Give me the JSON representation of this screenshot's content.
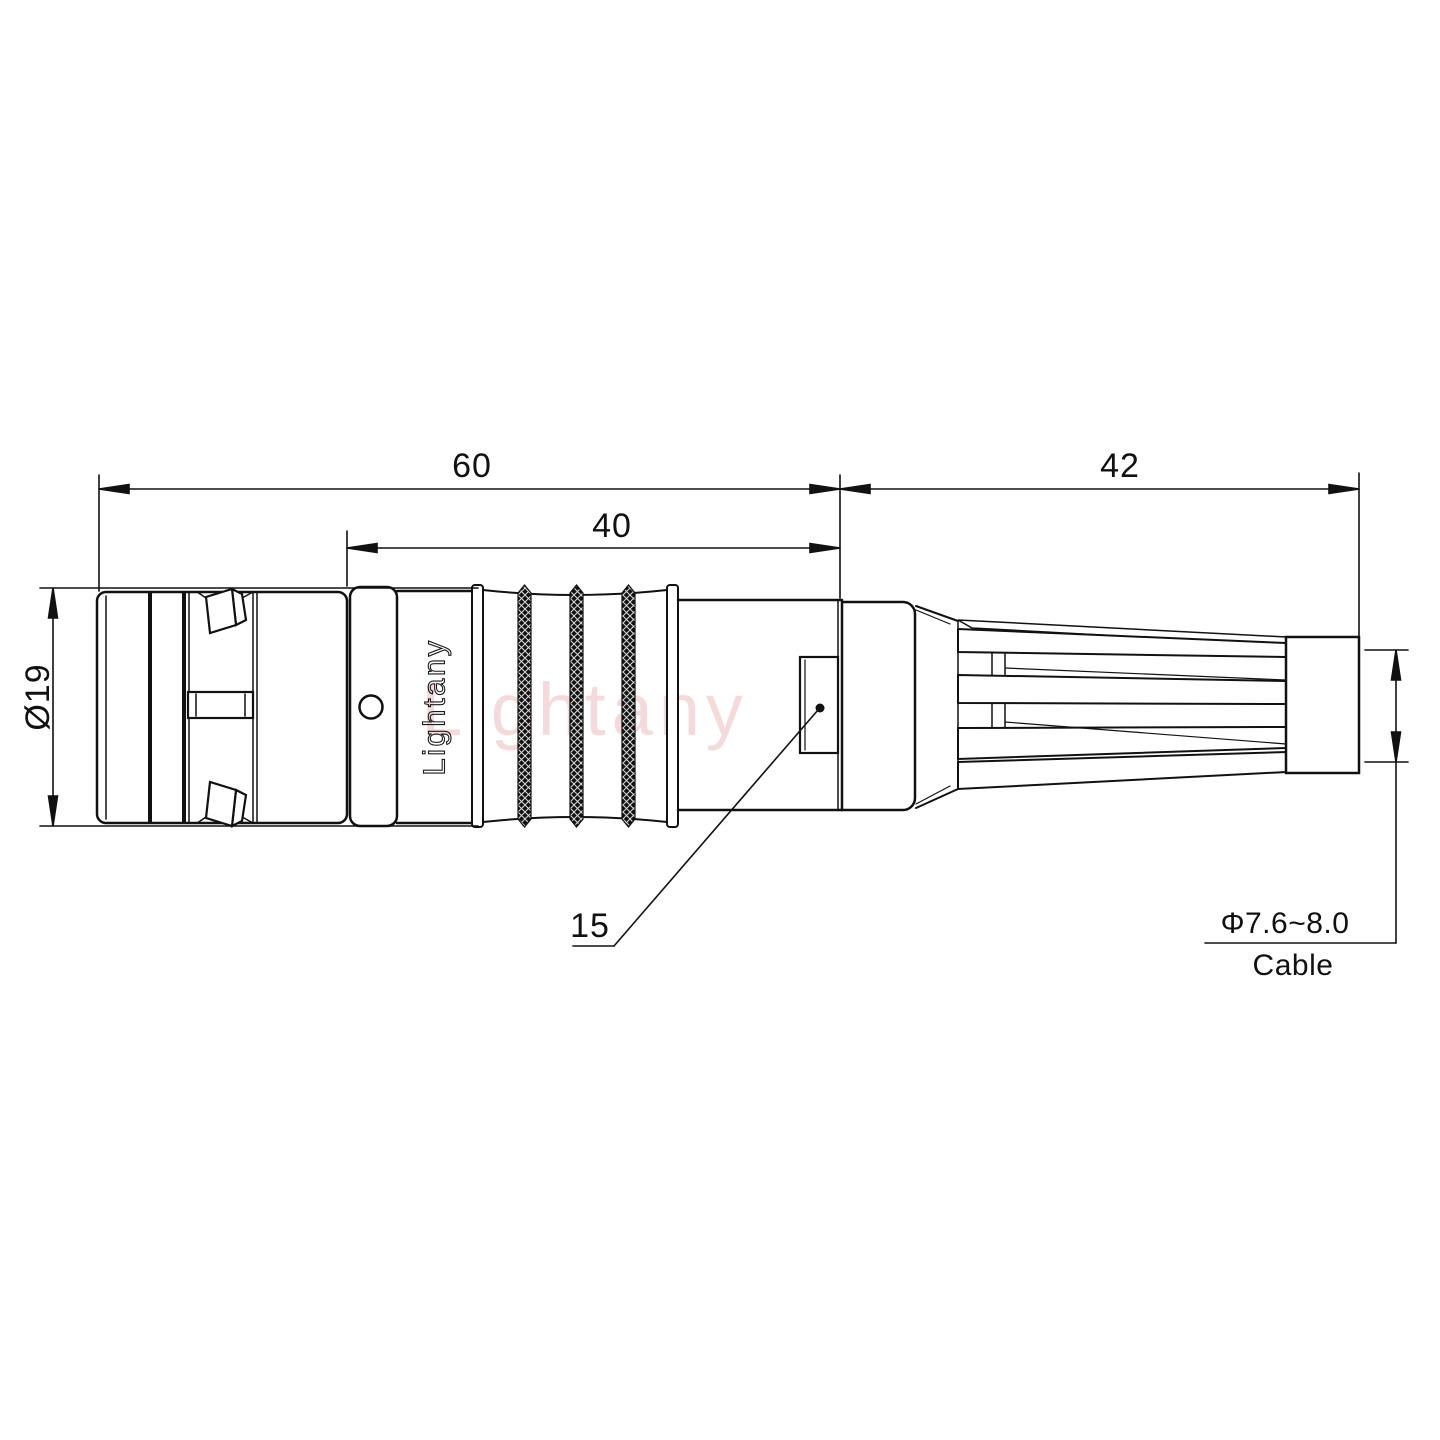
{
  "drawing": {
    "type": "connector-technical-drawing",
    "dims": {
      "total_length": "60",
      "body_length": "40",
      "backshell_length": "42",
      "front_diameter": "Ø19",
      "key_position": "15",
      "cable_range": "Φ7.6~8.0",
      "cable_word": "Cable"
    },
    "watermark": {
      "overlay_text": "Lightany",
      "body_text": "Lightany"
    },
    "colors": {
      "line": "#111111",
      "watermark": "#dd8888",
      "knurl": "#111111"
    }
  }
}
